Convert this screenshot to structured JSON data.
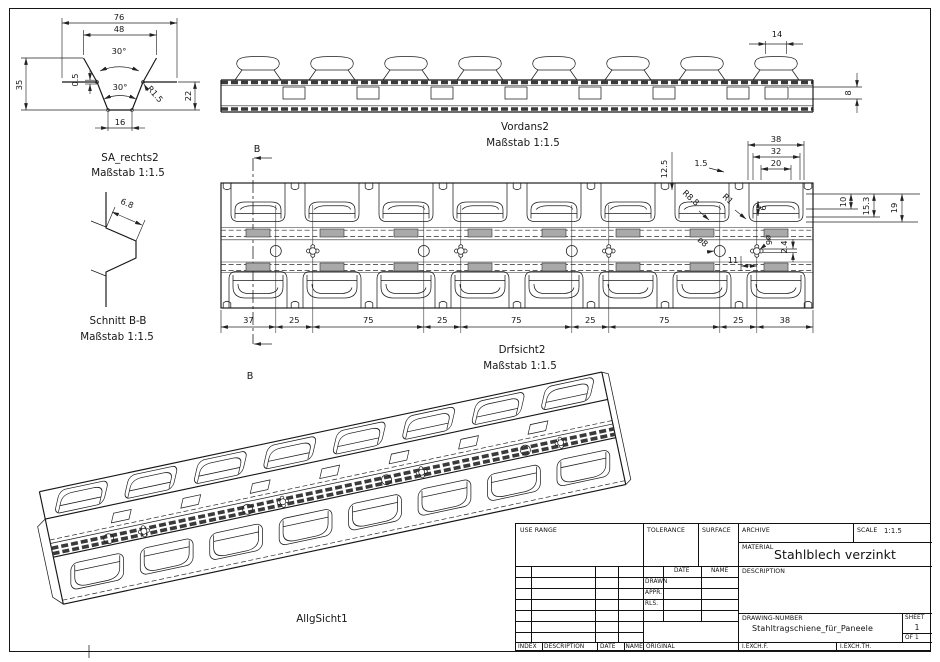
{
  "sheet": {
    "views": {
      "sa": {
        "title": "SA_rechts2",
        "scale_note": "Maßstab 1:1.5",
        "dims": {
          "w76": "76",
          "w48": "48",
          "ang_top": "30°",
          "ang_bottom": "30°",
          "h35": "35",
          "t05": "0.5",
          "r": "R1.5",
          "h22": "22",
          "w16": "16"
        }
      },
      "vordans": {
        "title": "Vordans2",
        "scale_note": "Maßstab 1:1.5",
        "dims": {
          "w14": "14",
          "h8": "8"
        }
      },
      "schnitt": {
        "title": "Schnitt B-B",
        "scale_note": "Maßstab 1:1.5",
        "dims": {
          "t68": "6.8"
        }
      },
      "drfsicht": {
        "title": "Drfsicht2",
        "scale_note": "Maßstab 1:1.5",
        "section_label": "B",
        "bottom_dims": [
          "37",
          "25",
          "75",
          "25",
          "75",
          "25",
          "75",
          "25",
          "38"
        ],
        "detail_dims": {
          "w38": "38",
          "w32": "32",
          "w20": "20",
          "t15": "1.5",
          "h125": "12.5",
          "r88": "R8.8",
          "r1": "R1",
          "h6": "6",
          "h10": "10",
          "h153": "15.3",
          "h19": "19",
          "dia8": "ø8",
          "dia6": "ø6",
          "w11": "11",
          "h24": "2.4"
        }
      },
      "allg": {
        "title": "AllgSicht1"
      }
    },
    "titleblock": {
      "use_range": "USE RANGE",
      "tolerance": "TOLERANCE",
      "surface": "SURFACE",
      "archive": "ARCHIVE",
      "scale_label": "SCALE",
      "scale_value": "1:1.5",
      "material_label": "MATERIAL",
      "material_value": "Stahlblech verzinkt",
      "date": "DATE",
      "name": "NAME",
      "drawn": "DRAWN",
      "appr": "APPR.",
      "rls": "RLS.",
      "description": "DESCRIPTION",
      "drawing_number_label": "DRAWING-NUMBER",
      "drawing_number": "Stahltragschiene_für_Paneele",
      "sheet_label": "SHEET",
      "sheet_value": "1",
      "of_value": "OF 1",
      "index": "INDEX",
      "description2": "DESCRIPTION",
      "date2": "DATE",
      "name2": "NAME",
      "original": "ORIGINAL",
      "iexchf": "I.EXCH.F.",
      "iexchth": "I.EXCH.TH."
    }
  }
}
